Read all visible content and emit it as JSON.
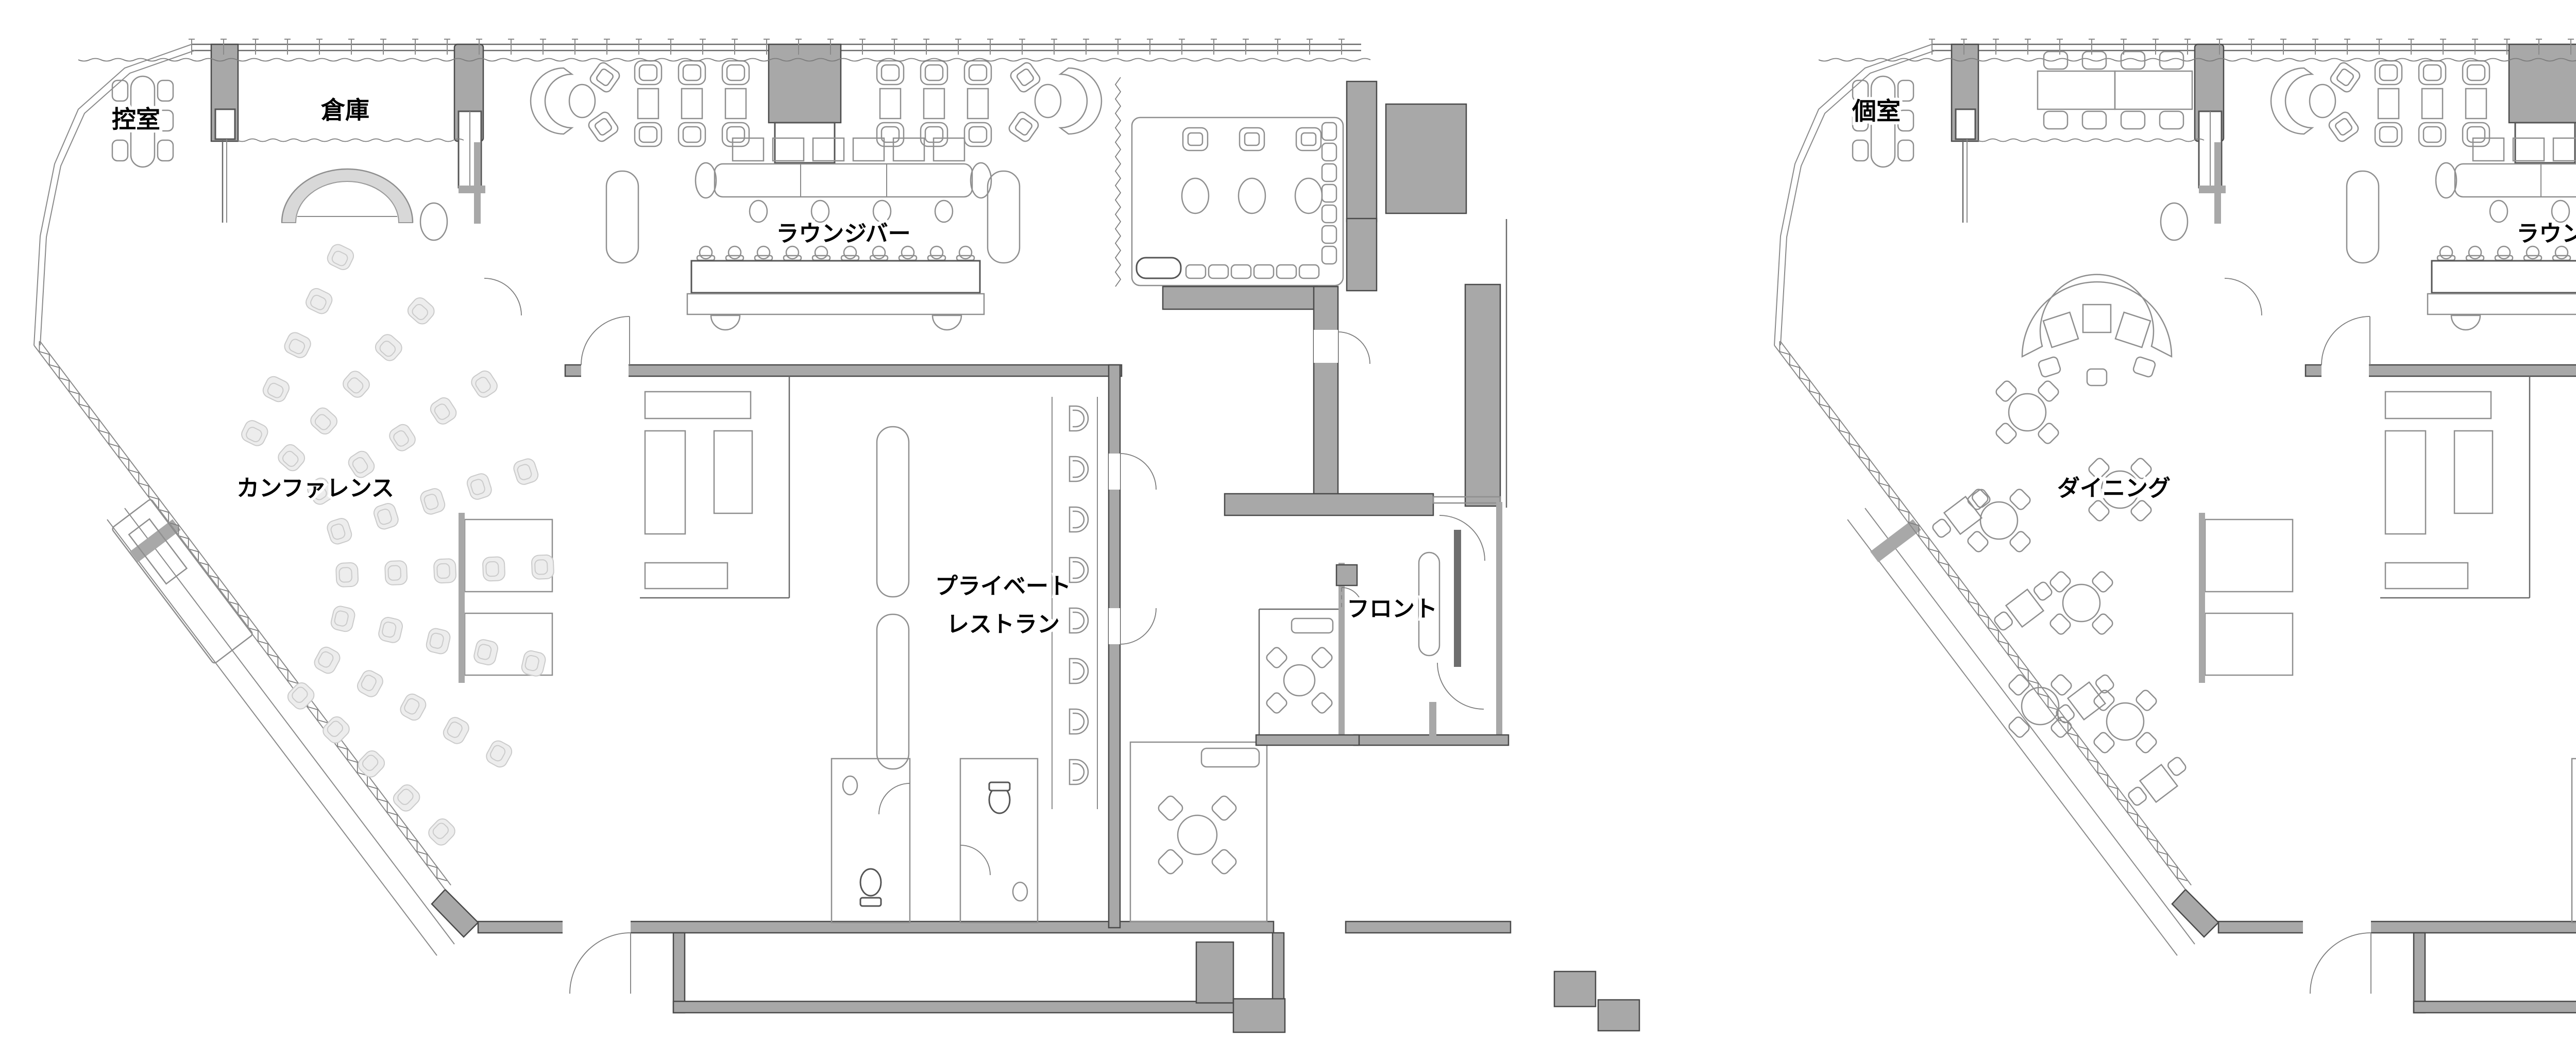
{
  "document": {
    "kind": "architectural floor plan comparison",
    "background": "#ffffff"
  },
  "palette": {
    "wall_fill": "#a8a8a8",
    "wall_edge": "#4a4a4a",
    "furniture_line": "#8f8f8f",
    "pale_seat_fill": "#ededed",
    "pale_seat_edge": "#cbcbcb",
    "canopy_band": "#d8d8d8",
    "label_text": "#000000"
  },
  "plans": [
    {
      "name": "plan-a",
      "rooms": {
        "top_left": "控室",
        "storage": "倉庫",
        "lounge": "ラウンジバー",
        "hall": "カンファレンス",
        "restaurant_line1": "プライベート",
        "restaurant_line2": "レストラン",
        "front": "フロント"
      }
    },
    {
      "name": "plan-b",
      "rooms": {
        "top_left": "個室",
        "lounge": "ラウンジバー",
        "hall": "ダイニング",
        "restaurant_line1": "プライベート",
        "restaurant_line2": "レストラン",
        "front": "フロント"
      }
    }
  ]
}
